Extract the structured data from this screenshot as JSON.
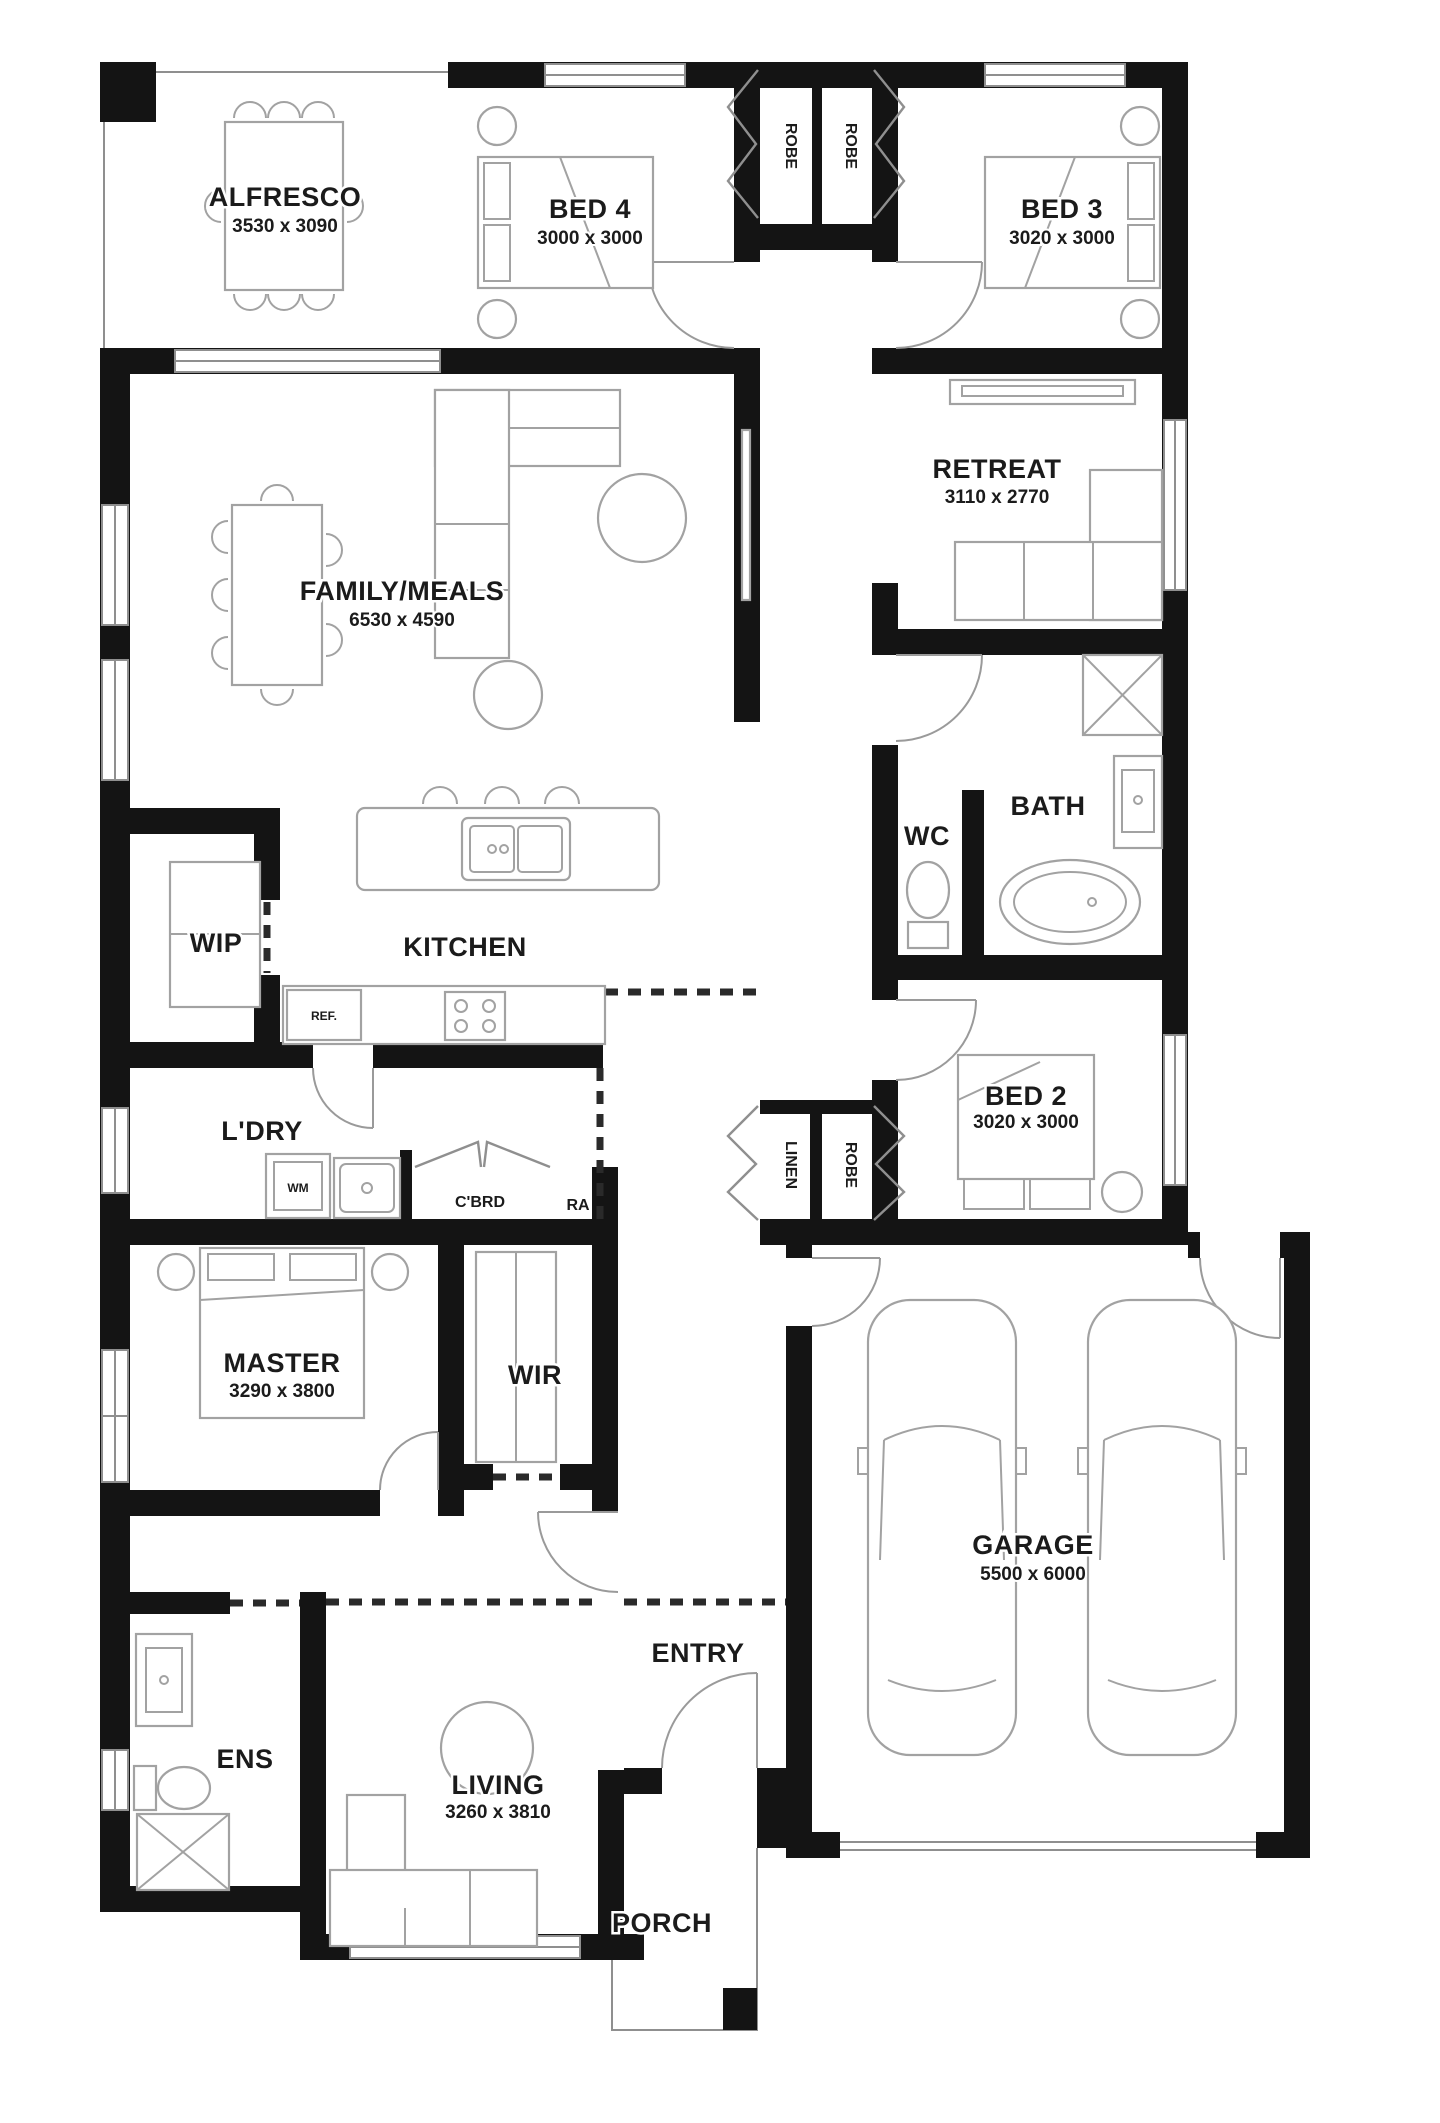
{
  "plan_title": "Single storey house floor plan",
  "colors": {
    "wall": "#141414",
    "furniture_outline": "#a2a2a2",
    "background": "#ffffff"
  },
  "rooms": {
    "alfresco": {
      "name": "ALFRESCO",
      "dims": "3530 x 3090"
    },
    "bed4": {
      "name": "BED 4",
      "dims": "3000 x 3000"
    },
    "bed3": {
      "name": "BED 3",
      "dims": "3020 x 3000"
    },
    "retreat": {
      "name": "RETREAT",
      "dims": "3110 x 2770"
    },
    "family": {
      "name": "FAMILY/MEALS",
      "dims": "6530 x 4590"
    },
    "kitchen": {
      "name": "KITCHEN"
    },
    "wip": {
      "name": "WIP"
    },
    "wc": {
      "name": "WC"
    },
    "bath": {
      "name": "BATH"
    },
    "ldry": {
      "name": "L'DRY"
    },
    "cbrd": {
      "name": "C'BRD"
    },
    "ra": {
      "name": "RA"
    },
    "linen": {
      "name": "LINEN"
    },
    "robe_bed4": {
      "name": "ROBE"
    },
    "robe_bed3": {
      "name": "ROBE"
    },
    "robe_bed2": {
      "name": "ROBE"
    },
    "bed2": {
      "name": "BED 2",
      "dims": "3020 x 3000"
    },
    "master": {
      "name": "MASTER",
      "dims": "3290 x 3800"
    },
    "wir": {
      "name": "WIR"
    },
    "garage": {
      "name": "GARAGE",
      "dims": "5500 x 6000"
    },
    "ens": {
      "name": "ENS"
    },
    "living": {
      "name": "LIVING",
      "dims": "3260 x 3810"
    },
    "entry": {
      "name": "ENTRY"
    },
    "porch": {
      "name": "PORCH"
    }
  },
  "appliances": {
    "fridge": "REF.",
    "washer": "WM"
  }
}
